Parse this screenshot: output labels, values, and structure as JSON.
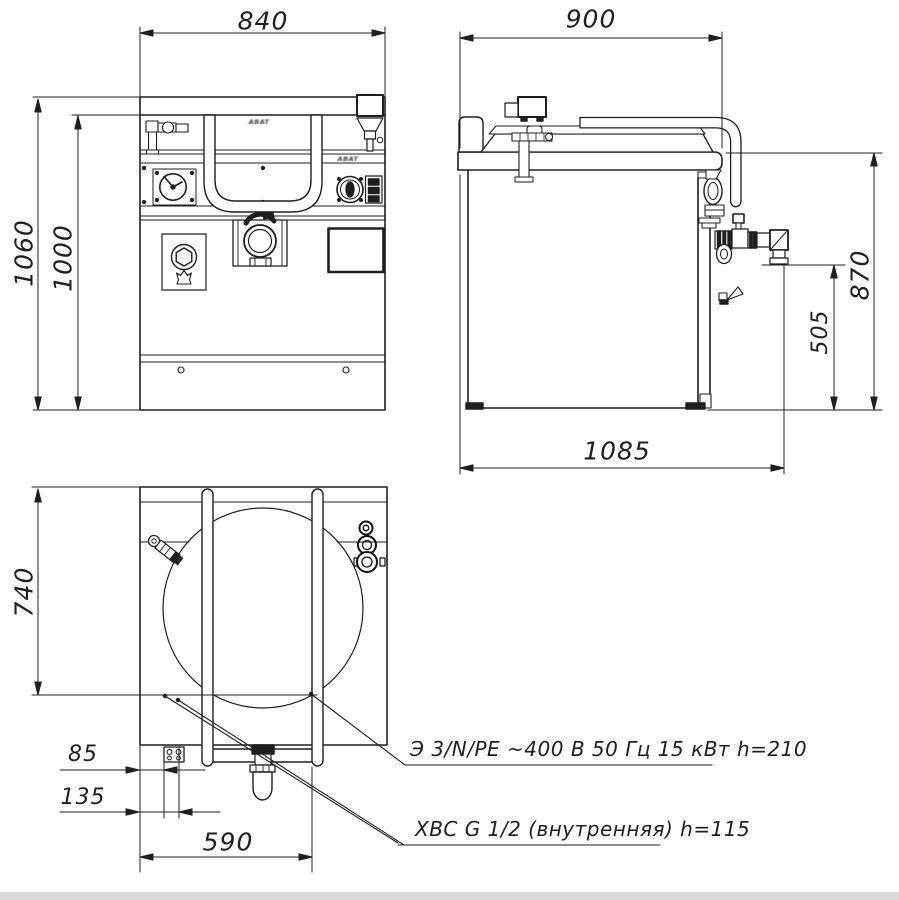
{
  "labels": {
    "front_width": "840",
    "side_depth": "900",
    "front_overall_height": "1060",
    "front_body_height": "1000",
    "side_surface_height": "870",
    "side_outlet_height": "505",
    "side_overall_depth": "1085",
    "top_depth": "740",
    "water_offset_a": "85",
    "water_offset_b": "135",
    "handle_spacing": "590"
  },
  "annotations": {
    "electrical": "Э 3/N/PE ~400 В 50 Гц 15 кВт h=210",
    "cold_water": "ХВС G 1/2 (внутренняя)  h=115"
  },
  "brand": {
    "logo": "ABAT"
  },
  "colors": {
    "line": "#1f1f1f",
    "background": "#ffffff",
    "page_edge": "#d9d9d9"
  }
}
